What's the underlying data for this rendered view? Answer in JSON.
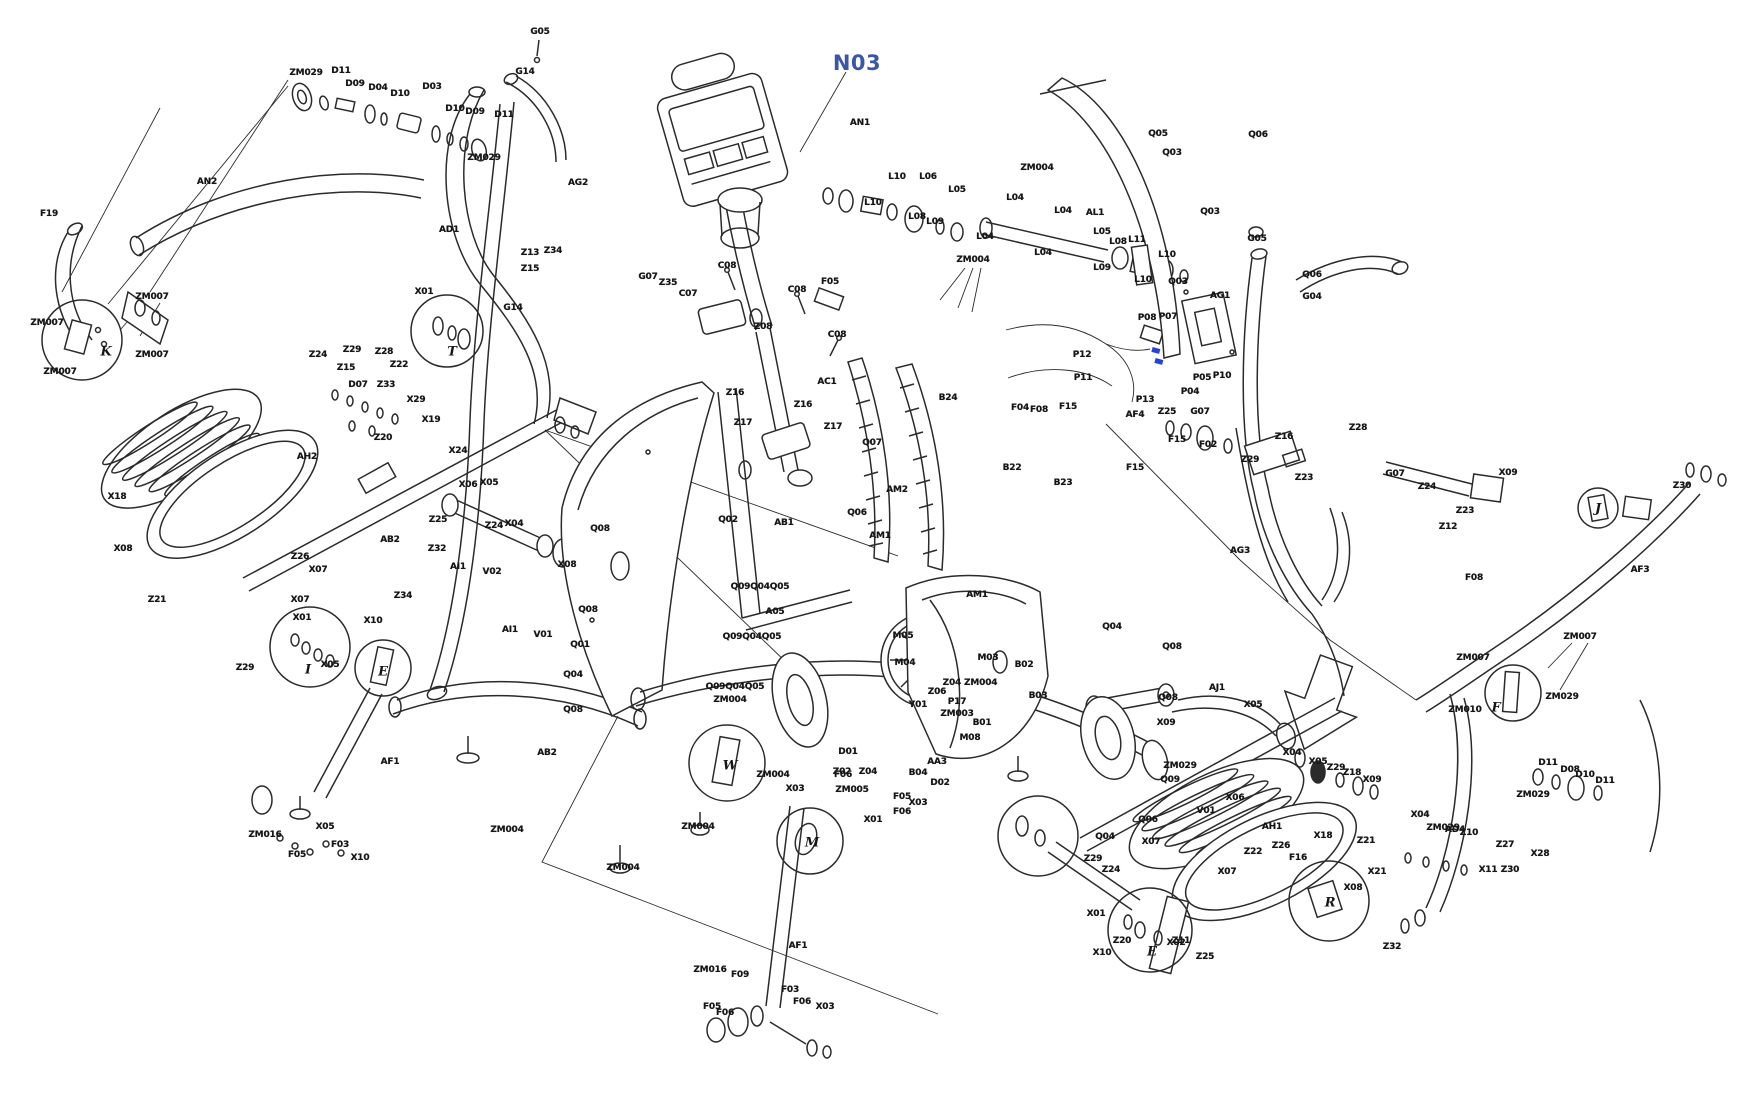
{
  "figure": {
    "type": "exploded-parts-diagram",
    "subject": "elliptical-trainer",
    "background": "#ffffff",
    "ink": "#2b2b2b",
    "highlight_label": {
      "text": "N03",
      "color": "#3a57a7"
    },
    "red_arrow": {
      "points_to": "X05",
      "color": "#e8262d"
    },
    "blue_connector_color": "#2743d6",
    "part_labels": [
      {
        "t": "N03",
        "x": 857,
        "y": 63,
        "k": "hl"
      },
      {
        "t": "ZM029",
        "x": 306,
        "y": 73
      },
      {
        "t": "D11",
        "x": 341,
        "y": 71
      },
      {
        "t": "D09",
        "x": 355,
        "y": 84
      },
      {
        "t": "D04",
        "x": 378,
        "y": 88
      },
      {
        "t": "D10",
        "x": 400,
        "y": 94
      },
      {
        "t": "D03",
        "x": 432,
        "y": 87
      },
      {
        "t": "D10",
        "x": 455,
        "y": 109
      },
      {
        "t": "D09",
        "x": 475,
        "y": 112
      },
      {
        "t": "D11",
        "x": 504,
        "y": 115
      },
      {
        "t": "ZM029",
        "x": 484,
        "y": 158
      },
      {
        "t": "G05",
        "x": 540,
        "y": 32
      },
      {
        "t": "G14",
        "x": 525,
        "y": 72
      },
      {
        "t": "AG2",
        "x": 578,
        "y": 183
      },
      {
        "t": "AD1",
        "x": 449,
        "y": 230
      },
      {
        "t": "G14",
        "x": 513,
        "y": 308
      },
      {
        "t": "X01",
        "x": 424,
        "y": 292
      },
      {
        "t": "Z13",
        "x": 530,
        "y": 253
      },
      {
        "t": "Z34",
        "x": 553,
        "y": 251
      },
      {
        "t": "Z15",
        "x": 530,
        "y": 269
      },
      {
        "t": "F19",
        "x": 49,
        "y": 214
      },
      {
        "t": "AN2",
        "x": 207,
        "y": 182
      },
      {
        "t": "ZM007",
        "x": 152,
        "y": 297
      },
      {
        "t": "ZM007",
        "x": 47,
        "y": 323
      },
      {
        "t": "ZM007",
        "x": 60,
        "y": 372
      },
      {
        "t": "ZM007",
        "x": 152,
        "y": 355
      },
      {
        "t": "Z24",
        "x": 318,
        "y": 355
      },
      {
        "t": "Z29",
        "x": 352,
        "y": 350
      },
      {
        "t": "Z28",
        "x": 384,
        "y": 352
      },
      {
        "t": "Z15",
        "x": 346,
        "y": 368
      },
      {
        "t": "Z22",
        "x": 399,
        "y": 365
      },
      {
        "t": "D07",
        "x": 358,
        "y": 385
      },
      {
        "t": "Z33",
        "x": 386,
        "y": 385
      },
      {
        "t": "X29",
        "x": 416,
        "y": 400
      },
      {
        "t": "X19",
        "x": 431,
        "y": 420
      },
      {
        "t": "Z20",
        "x": 383,
        "y": 438
      },
      {
        "t": "X24",
        "x": 458,
        "y": 451
      },
      {
        "t": "X18",
        "x": 117,
        "y": 497
      },
      {
        "t": "X08",
        "x": 123,
        "y": 549
      },
      {
        "t": "Z21",
        "x": 157,
        "y": 600
      },
      {
        "t": "AH2",
        "x": 307,
        "y": 457
      },
      {
        "t": "AB2",
        "x": 390,
        "y": 540
      },
      {
        "t": "Z26",
        "x": 300,
        "y": 557
      },
      {
        "t": "X07",
        "x": 318,
        "y": 570
      },
      {
        "t": "Z34",
        "x": 403,
        "y": 596
      },
      {
        "t": "X10",
        "x": 373,
        "y": 621
      },
      {
        "t": "X01",
        "x": 302,
        "y": 618
      },
      {
        "t": "Z29",
        "x": 245,
        "y": 668
      },
      {
        "t": "X06",
        "x": 468,
        "y": 485
      },
      {
        "t": "X05",
        "x": 489,
        "y": 483
      },
      {
        "t": "Z25",
        "x": 438,
        "y": 520
      },
      {
        "t": "Z24",
        "x": 494,
        "y": 526
      },
      {
        "t": "X04",
        "x": 514,
        "y": 524
      },
      {
        "t": "Z32",
        "x": 437,
        "y": 549
      },
      {
        "t": "AI1",
        "x": 458,
        "y": 567
      },
      {
        "t": "AI1",
        "x": 510,
        "y": 630
      },
      {
        "t": "V01",
        "x": 543,
        "y": 635
      },
      {
        "t": "Q08",
        "x": 600,
        "y": 529
      },
      {
        "t": "X08",
        "x": 567,
        "y": 565
      },
      {
        "t": "Q08",
        "x": 588,
        "y": 610
      },
      {
        "t": "Q01",
        "x": 580,
        "y": 645
      },
      {
        "t": "Q04",
        "x": 573,
        "y": 675
      },
      {
        "t": "Q08",
        "x": 573,
        "y": 710
      },
      {
        "t": "V02",
        "x": 492,
        "y": 572
      },
      {
        "t": "C08",
        "x": 727,
        "y": 266
      },
      {
        "t": "G07",
        "x": 648,
        "y": 277
      },
      {
        "t": "Z35",
        "x": 668,
        "y": 283
      },
      {
        "t": "C07",
        "x": 688,
        "y": 294
      },
      {
        "t": "F05",
        "x": 830,
        "y": 282
      },
      {
        "t": "C08",
        "x": 797,
        "y": 290
      },
      {
        "t": "Z08",
        "x": 763,
        "y": 327
      },
      {
        "t": "C08",
        "x": 837,
        "y": 335
      },
      {
        "t": "AC1",
        "x": 827,
        "y": 382
      },
      {
        "t": "Z16",
        "x": 735,
        "y": 393
      },
      {
        "t": "Z17",
        "x": 743,
        "y": 423
      },
      {
        "t": "Z16",
        "x": 803,
        "y": 405
      },
      {
        "t": "Z17",
        "x": 833,
        "y": 427
      },
      {
        "t": "Q07",
        "x": 872,
        "y": 443
      },
      {
        "t": "AN1",
        "x": 860,
        "y": 123
      },
      {
        "t": "L10",
        "x": 897,
        "y": 177
      },
      {
        "t": "L06",
        "x": 928,
        "y": 177
      },
      {
        "t": "L05",
        "x": 957,
        "y": 190
      },
      {
        "t": "L10",
        "x": 873,
        "y": 203
      },
      {
        "t": "L08",
        "x": 917,
        "y": 217
      },
      {
        "t": "L09",
        "x": 935,
        "y": 222
      },
      {
        "t": "ZM004",
        "x": 973,
        "y": 260
      },
      {
        "t": "ZM004",
        "x": 1037,
        "y": 168
      },
      {
        "t": "L04",
        "x": 1015,
        "y": 198
      },
      {
        "t": "L04",
        "x": 1063,
        "y": 211
      },
      {
        "t": "AL1",
        "x": 1095,
        "y": 213
      },
      {
        "t": "L04",
        "x": 985,
        "y": 237
      },
      {
        "t": "L04",
        "x": 1043,
        "y": 253
      },
      {
        "t": "L05",
        "x": 1102,
        "y": 232
      },
      {
        "t": "L08",
        "x": 1118,
        "y": 242
      },
      {
        "t": "L11",
        "x": 1137,
        "y": 240
      },
      {
        "t": "L10",
        "x": 1167,
        "y": 255
      },
      {
        "t": "L09",
        "x": 1102,
        "y": 268
      },
      {
        "t": "L10",
        "x": 1143,
        "y": 280
      },
      {
        "t": "Q05",
        "x": 1158,
        "y": 134
      },
      {
        "t": "Q03",
        "x": 1172,
        "y": 153
      },
      {
        "t": "Q06",
        "x": 1258,
        "y": 135
      },
      {
        "t": "Q03",
        "x": 1210,
        "y": 212
      },
      {
        "t": "Q03",
        "x": 1178,
        "y": 282
      },
      {
        "t": "Q06",
        "x": 1312,
        "y": 275
      },
      {
        "t": "P08",
        "x": 1147,
        "y": 318
      },
      {
        "t": "P07",
        "x": 1168,
        "y": 317
      },
      {
        "t": "P12",
        "x": 1082,
        "y": 355
      },
      {
        "t": "P11",
        "x": 1083,
        "y": 378
      },
      {
        "t": "P05",
        "x": 1202,
        "y": 378
      },
      {
        "t": "P10",
        "x": 1222,
        "y": 376
      },
      {
        "t": "P04",
        "x": 1190,
        "y": 392
      },
      {
        "t": "P13",
        "x": 1145,
        "y": 400
      },
      {
        "t": "AF4",
        "x": 1135,
        "y": 415
      },
      {
        "t": "F04",
        "x": 1020,
        "y": 408
      },
      {
        "t": "F08",
        "x": 1039,
        "y": 410
      },
      {
        "t": "F15",
        "x": 1068,
        "y": 407
      },
      {
        "t": "F15",
        "x": 1135,
        "y": 468
      },
      {
        "t": "F15",
        "x": 1177,
        "y": 440
      },
      {
        "t": "F02",
        "x": 1208,
        "y": 445
      },
      {
        "t": "B24",
        "x": 948,
        "y": 398
      },
      {
        "t": "B22",
        "x": 1012,
        "y": 468
      },
      {
        "t": "B23",
        "x": 1063,
        "y": 483
      },
      {
        "t": "AM2",
        "x": 897,
        "y": 490
      },
      {
        "t": "AM1",
        "x": 880,
        "y": 536
      },
      {
        "t": "AG1",
        "x": 1220,
        "y": 296
      },
      {
        "t": "G04",
        "x": 1312,
        "y": 297
      },
      {
        "t": "G05",
        "x": 1257,
        "y": 239
      },
      {
        "t": "Z25",
        "x": 1167,
        "y": 412
      },
      {
        "t": "G07",
        "x": 1200,
        "y": 412
      },
      {
        "t": "Z16",
        "x": 1284,
        "y": 437
      },
      {
        "t": "Z29",
        "x": 1250,
        "y": 460
      },
      {
        "t": "Z23",
        "x": 1304,
        "y": 478
      },
      {
        "t": "AG3",
        "x": 1240,
        "y": 551
      },
      {
        "t": "Z28",
        "x": 1358,
        "y": 428
      },
      {
        "t": "G07",
        "x": 1395,
        "y": 474
      },
      {
        "t": "Z24",
        "x": 1427,
        "y": 487
      },
      {
        "t": "Z23",
        "x": 1465,
        "y": 511
      },
      {
        "t": "Z12",
        "x": 1448,
        "y": 527
      },
      {
        "t": "X09",
        "x": 1508,
        "y": 473
      },
      {
        "t": "Z30",
        "x": 1682,
        "y": 486
      },
      {
        "t": "AF3",
        "x": 1640,
        "y": 570
      },
      {
        "t": "F08",
        "x": 1474,
        "y": 578
      },
      {
        "t": "ZM007",
        "x": 1580,
        "y": 637
      },
      {
        "t": "ZM007",
        "x": 1473,
        "y": 658
      },
      {
        "t": "ZM029",
        "x": 1562,
        "y": 697
      },
      {
        "t": "ZM010",
        "x": 1465,
        "y": 710
      },
      {
        "t": "AM1",
        "x": 977,
        "y": 595
      },
      {
        "t": "M05",
        "x": 903,
        "y": 636
      },
      {
        "t": "M04",
        "x": 905,
        "y": 663
      },
      {
        "t": "M03",
        "x": 988,
        "y": 658
      },
      {
        "t": "B02",
        "x": 1024,
        "y": 665
      },
      {
        "t": "B03",
        "x": 1038,
        "y": 696
      },
      {
        "t": "Z06",
        "x": 937,
        "y": 692
      },
      {
        "t": "Z04 ZM004",
        "x": 970,
        "y": 683
      },
      {
        "t": "P17",
        "x": 957,
        "y": 702
      },
      {
        "t": "Y01",
        "x": 918,
        "y": 705
      },
      {
        "t": "ZM003",
        "x": 957,
        "y": 714
      },
      {
        "t": "B01",
        "x": 982,
        "y": 723
      },
      {
        "t": "M08",
        "x": 970,
        "y": 738
      },
      {
        "t": "AA3",
        "x": 937,
        "y": 762
      },
      {
        "t": "B04",
        "x": 918,
        "y": 773
      },
      {
        "t": "D02",
        "x": 940,
        "y": 783
      },
      {
        "t": "D01",
        "x": 848,
        "y": 752
      },
      {
        "t": "Z02",
        "x": 842,
        "y": 772
      },
      {
        "t": "Z04",
        "x": 868,
        "y": 772
      },
      {
        "t": "ZM005",
        "x": 852,
        "y": 790
      },
      {
        "t": "Q09Q04Q05",
        "x": 760,
        "y": 587
      },
      {
        "t": "A05",
        "x": 775,
        "y": 612
      },
      {
        "t": "Q09Q04Q05",
        "x": 752,
        "y": 637
      },
      {
        "t": "Q09Q04Q05",
        "x": 735,
        "y": 687
      },
      {
        "t": "ZM004",
        "x": 730,
        "y": 700
      },
      {
        "t": "Q02",
        "x": 728,
        "y": 520
      },
      {
        "t": "AB1",
        "x": 784,
        "y": 523
      },
      {
        "t": "Q06",
        "x": 857,
        "y": 513
      },
      {
        "t": "Q04",
        "x": 1112,
        "y": 627
      },
      {
        "t": "Q08",
        "x": 1172,
        "y": 647
      },
      {
        "t": "Q08",
        "x": 1168,
        "y": 698
      },
      {
        "t": "Q09",
        "x": 1170,
        "y": 780
      },
      {
        "t": "AJ1",
        "x": 1217,
        "y": 688
      },
      {
        "t": "X05",
        "x": 1253,
        "y": 705
      },
      {
        "t": "X09",
        "x": 1166,
        "y": 723
      },
      {
        "t": "ZM029",
        "x": 1180,
        "y": 766
      },
      {
        "t": "X06",
        "x": 1235,
        "y": 798
      },
      {
        "t": "X04",
        "x": 1292,
        "y": 753
      },
      {
        "t": "X05",
        "x": 1318,
        "y": 762
      },
      {
        "t": "Z29",
        "x": 1336,
        "y": 768
      },
      {
        "t": "Z18",
        "x": 1352,
        "y": 773
      },
      {
        "t": "X09",
        "x": 1372,
        "y": 780
      },
      {
        "t": "V01",
        "x": 1206,
        "y": 811
      },
      {
        "t": "Q06",
        "x": 1148,
        "y": 820
      },
      {
        "t": "Q04",
        "x": 1105,
        "y": 837
      },
      {
        "t": "X07",
        "x": 1151,
        "y": 842
      },
      {
        "t": "Z29",
        "x": 1093,
        "y": 859
      },
      {
        "t": "Z24",
        "x": 1111,
        "y": 870
      },
      {
        "t": "X01",
        "x": 1096,
        "y": 914
      },
      {
        "t": "X10",
        "x": 1102,
        "y": 953
      },
      {
        "t": "X02",
        "x": 1176,
        "y": 943
      },
      {
        "t": "Z25",
        "x": 1205,
        "y": 957
      },
      {
        "t": "Z20",
        "x": 1122,
        "y": 941
      },
      {
        "t": "Z11",
        "x": 1181,
        "y": 941
      },
      {
        "t": "X18",
        "x": 1323,
        "y": 836
      },
      {
        "t": "X08",
        "x": 1353,
        "y": 888
      },
      {
        "t": "X07",
        "x": 1227,
        "y": 872
      },
      {
        "t": "Z21",
        "x": 1366,
        "y": 841
      },
      {
        "t": "Z32",
        "x": 1392,
        "y": 947
      },
      {
        "t": "AH1",
        "x": 1272,
        "y": 827
      },
      {
        "t": "Z22",
        "x": 1253,
        "y": 852
      },
      {
        "t": "Z26",
        "x": 1281,
        "y": 846
      },
      {
        "t": "F16",
        "x": 1298,
        "y": 858
      },
      {
        "t": "X21",
        "x": 1377,
        "y": 872
      },
      {
        "t": "X04",
        "x": 1420,
        "y": 815
      },
      {
        "t": "ZM029",
        "x": 1443,
        "y": 828
      },
      {
        "t": "Z10",
        "x": 1469,
        "y": 833
      },
      {
        "t": "Z27",
        "x": 1505,
        "y": 845
      },
      {
        "t": "X11",
        "x": 1488,
        "y": 870
      },
      {
        "t": "Z30",
        "x": 1510,
        "y": 870
      },
      {
        "t": "X28",
        "x": 1540,
        "y": 854
      },
      {
        "t": "AD4",
        "x": 1455,
        "y": 830
      },
      {
        "t": "D11",
        "x": 1548,
        "y": 763
      },
      {
        "t": "D08",
        "x": 1570,
        "y": 770
      },
      {
        "t": "D10",
        "x": 1585,
        "y": 775
      },
      {
        "t": "ZM029",
        "x": 1533,
        "y": 795
      },
      {
        "t": "D11",
        "x": 1605,
        "y": 781
      },
      {
        "t": "ZM004",
        "x": 773,
        "y": 775
      },
      {
        "t": "X03",
        "x": 795,
        "y": 789
      },
      {
        "t": "ZM004",
        "x": 698,
        "y": 827
      },
      {
        "t": "ZM004",
        "x": 623,
        "y": 868
      },
      {
        "t": "AF1",
        "x": 798,
        "y": 946
      },
      {
        "t": "ZM016",
        "x": 710,
        "y": 970
      },
      {
        "t": "F09",
        "x": 740,
        "y": 975
      },
      {
        "t": "F05",
        "x": 712,
        "y": 1007
      },
      {
        "t": "F06",
        "x": 725,
        "y": 1013
      },
      {
        "t": "F03",
        "x": 790,
        "y": 990
      },
      {
        "t": "F06",
        "x": 802,
        "y": 1002
      },
      {
        "t": "X03",
        "x": 825,
        "y": 1007
      },
      {
        "t": "F06",
        "x": 843,
        "y": 775
      },
      {
        "t": "F05",
        "x": 902,
        "y": 797
      },
      {
        "t": "F06",
        "x": 902,
        "y": 812
      },
      {
        "t": "X03",
        "x": 918,
        "y": 803
      },
      {
        "t": "X01",
        "x": 873,
        "y": 820
      },
      {
        "t": "AF1",
        "x": 390,
        "y": 762
      },
      {
        "t": "AB2",
        "x": 547,
        "y": 753
      },
      {
        "t": "ZM004",
        "x": 507,
        "y": 830
      },
      {
        "t": "ZM016",
        "x": 265,
        "y": 835
      },
      {
        "t": "X05",
        "x": 325,
        "y": 827
      },
      {
        "t": "F05",
        "x": 297,
        "y": 855
      },
      {
        "t": "X10",
        "x": 360,
        "y": 858
      },
      {
        "t": "F03",
        "x": 340,
        "y": 845
      },
      {
        "t": "X05",
        "x": 330,
        "y": 665
      },
      {
        "t": "X07",
        "x": 300,
        "y": 600
      }
    ],
    "detail_callouts": [
      {
        "t": "K",
        "x": 106,
        "y": 352
      },
      {
        "t": "T",
        "x": 452,
        "y": 352
      },
      {
        "t": "I",
        "x": 308,
        "y": 670
      },
      {
        "t": "E",
        "x": 383,
        "y": 672
      },
      {
        "t": "W",
        "x": 730,
        "y": 766
      },
      {
        "t": "M",
        "x": 812,
        "y": 843
      },
      {
        "t": "E",
        "x": 1152,
        "y": 952
      },
      {
        "t": "F",
        "x": 1496,
        "y": 708
      },
      {
        "t": "J",
        "x": 1598,
        "y": 509
      },
      {
        "t": "R",
        "x": 1330,
        "y": 903
      }
    ]
  }
}
